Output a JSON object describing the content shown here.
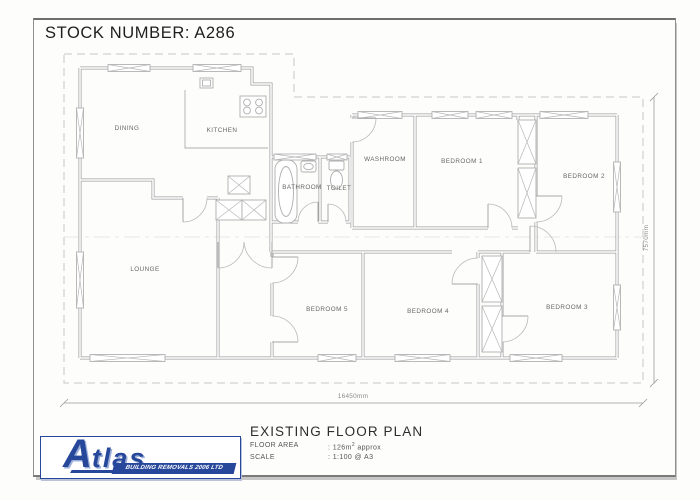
{
  "title": {
    "stock_number": "STOCK NUMBER: A286"
  },
  "plan": {
    "rooms": {
      "dining": "DINING",
      "kitchen": "KITCHEN",
      "bathroom": "BATHROOM",
      "toilet": "TOILET",
      "washroom": "WASHROOM",
      "bedroom1": "BEDROOM 1",
      "bedroom2": "BEDROOM 2",
      "bedroom3": "BEDROOM 3",
      "bedroom4": "BEDROOM 4",
      "bedroom5": "BEDROOM 5",
      "lounge": "LOUNGE"
    },
    "dimensions": {
      "width": "16450mm",
      "height": "7570mm"
    }
  },
  "footer": {
    "drawing_title": "EXISTING FLOOR PLAN",
    "floor_area_label": "FLOOR AREA",
    "floor_area_value_prefix": ": 126m",
    "floor_area_sup": "2",
    "floor_area_value_suffix": " approx",
    "scale_label": "SCALE",
    "scale_value": ": 1:100 @ A3",
    "logo": {
      "brand_initial": "A",
      "brand_rest": "tlas",
      "tagline": "BUILDING REMOVALS 2006 LTD"
    }
  },
  "colors": {
    "logo_blue": "#27479B",
    "line_gray": "#a0a0a0",
    "dash_gray": "#c6c6c6"
  }
}
